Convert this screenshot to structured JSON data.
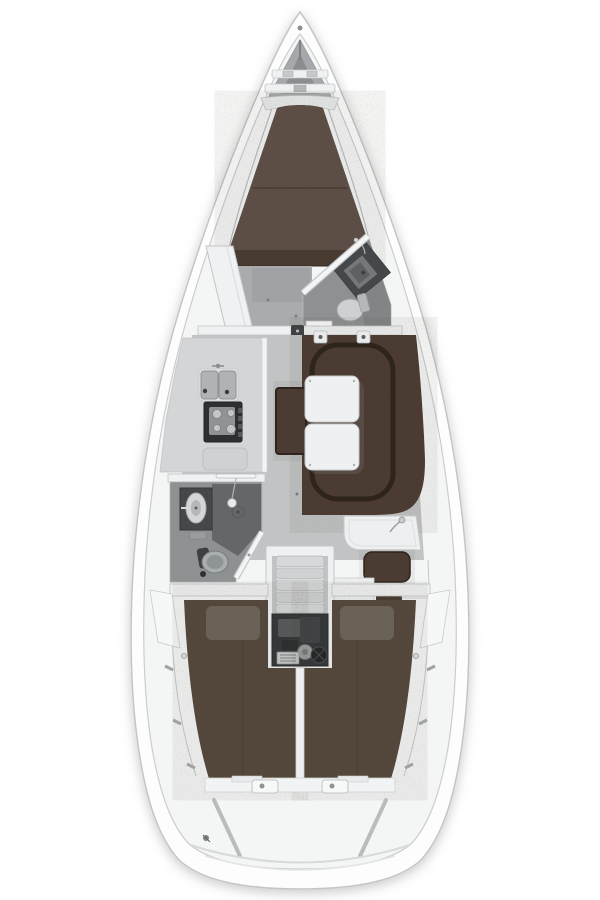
{
  "canvas": {
    "width": 600,
    "height": 900
  },
  "diagram_type": "sailing-yacht-interior-floor-plan",
  "regions": [
    "anchor-locker",
    "v-berth",
    "forward-wardrobe",
    "forward-head",
    "main-bulkhead",
    "galley",
    "saloon-settee",
    "saloon-table",
    "saloon-bench",
    "aft-head",
    "nav-station",
    "companionway-steps",
    "engine-compartment",
    "port-aft-berth",
    "starboard-aft-berth",
    "transom"
  ],
  "colors": {
    "page_bg": "#ffffff",
    "hull_fill": "#fdfdfd",
    "hull_stroke": "#c2c5c6",
    "deck_fill": "#f4f5f5",
    "deck_stroke": "#cbcdce",
    "locker_wall": "#a6a9ab",
    "locker_inner": "#8b8e90",
    "trim_white": "#f0f1f2",
    "trim_stroke": "#c2c4c5",
    "vberth": "#5d5046",
    "vberth_seam": "#463b32",
    "cabinet_brown": "#483b31",
    "floor_fwd": "#a9abac",
    "floor_saloon": "#c1c3c4",
    "floor_head": "#8d9192",
    "shower_dark": "#63676a",
    "cabinet_dark": "#44484a",
    "toilet_light": "#ced1d2",
    "counter": "#d3d5d6",
    "sink_basin": "#b0b3b5",
    "stove_dark": "#2d3032",
    "settee": "#4b3b30",
    "settee_trim": "#2f241c",
    "table_top": "#eef0f1",
    "steps": "#d6d8d9",
    "engine_bg": "#33373a",
    "engine_metal": "#9ea2a3",
    "aft_berth": "#55463b",
    "pillow": "#6f665d",
    "hardware": "#8d9091"
  }
}
